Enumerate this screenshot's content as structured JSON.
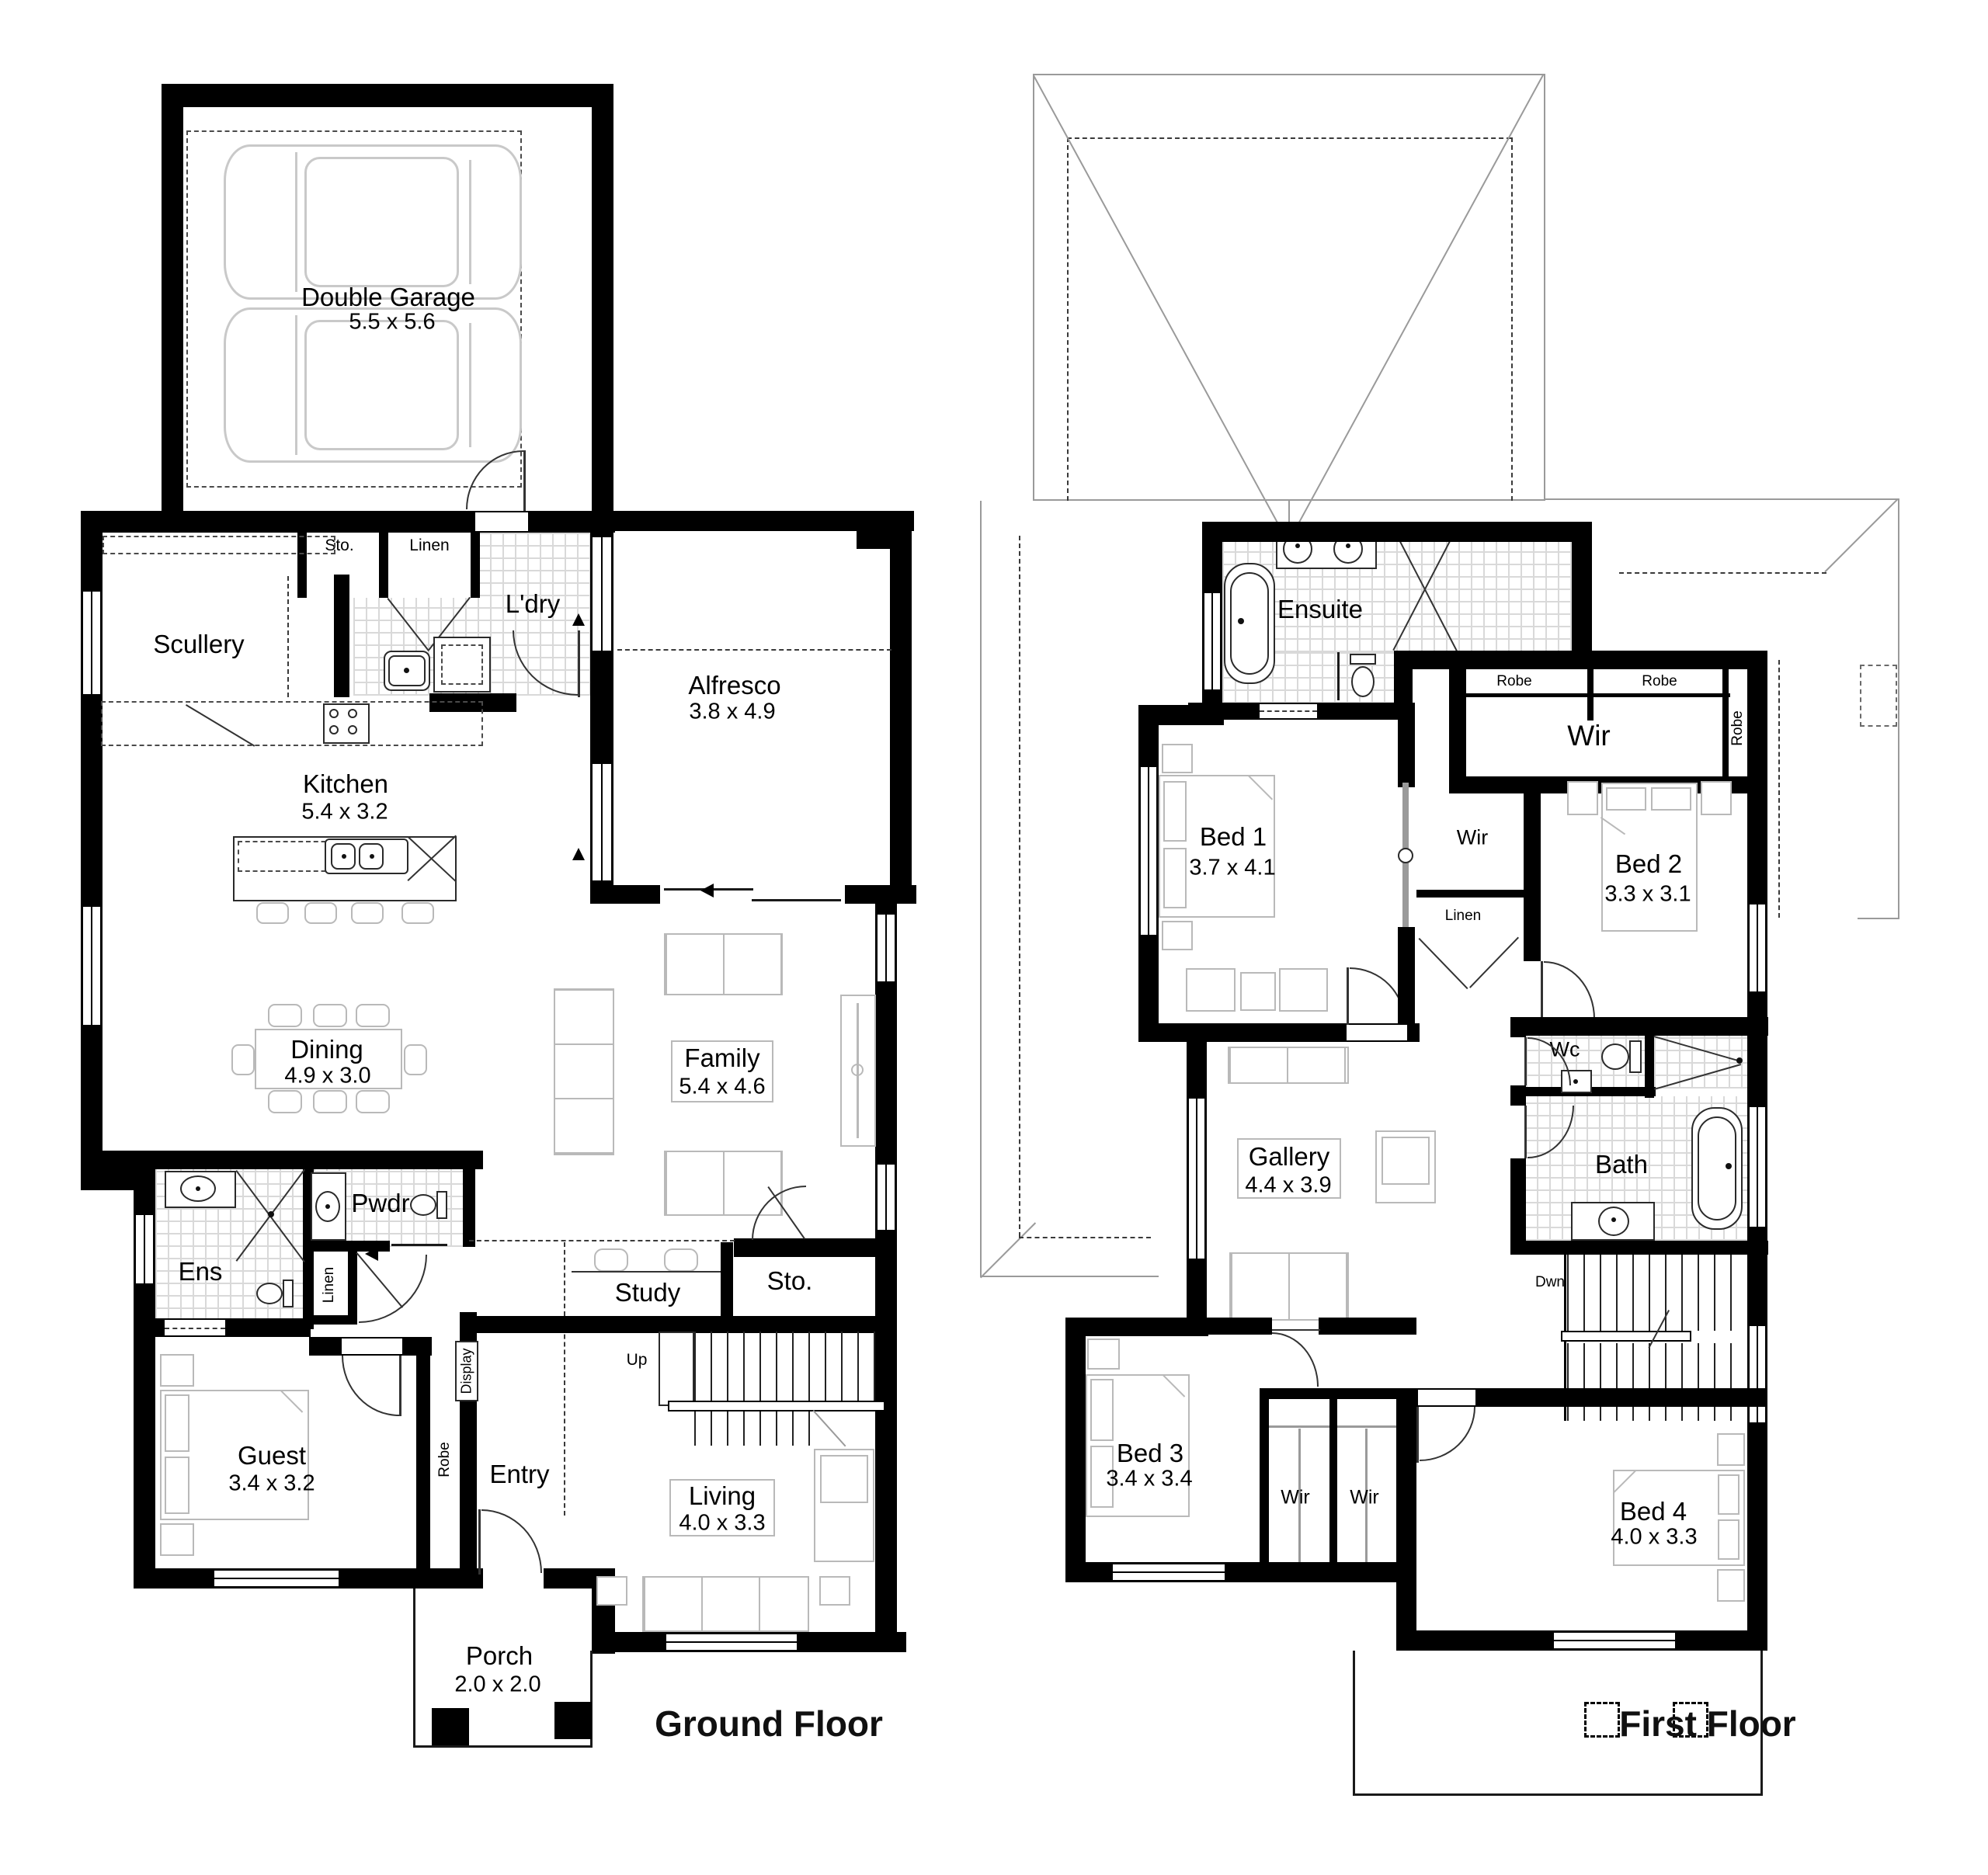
{
  "ground_floor": {
    "title": "Ground Floor",
    "garage": {
      "name": "Double Garage",
      "dims": "5.5 x 5.6"
    },
    "scullery": "Scullery",
    "sto_top": "Sto.",
    "linen_top": "Linen",
    "laundry": "L'dry",
    "alfresco": {
      "name": "Alfresco",
      "dims": "3.8 x 4.9"
    },
    "kitchen": {
      "name": "Kitchen",
      "dims": "5.4 x 3.2"
    },
    "dining": {
      "name": "Dining",
      "dims": "4.9 x 3.0"
    },
    "family": {
      "name": "Family",
      "dims": "5.4 x 4.6"
    },
    "ensuite": "Ens",
    "powder": "Pwdr",
    "linen_hall": "Linen",
    "display": "Display",
    "study": "Study",
    "storage": "Sto.",
    "stairs_up": "Up",
    "guest": {
      "name": "Guest",
      "dims": "3.4 x 3.2"
    },
    "robe": "Robe",
    "entry": "Entry",
    "living": {
      "name": "Living",
      "dims": "4.0 x 3.3"
    },
    "porch": {
      "name": "Porch",
      "dims": "2.0 x 2.0"
    }
  },
  "first_floor": {
    "title": "First Floor",
    "ensuite": "Ensuite",
    "robe_1": "Robe",
    "robe_2": "Robe",
    "robe_3": "Robe",
    "wir_main": "Wir",
    "bed1": {
      "name": "Bed 1",
      "dims": "3.7 x 4.1"
    },
    "wir_mid": "Wir",
    "linen": "Linen",
    "bed2": {
      "name": "Bed 2",
      "dims": "3.3 x 3.1"
    },
    "wc": "Wc",
    "bath": "Bath",
    "gallery": {
      "name": "Gallery",
      "dims": "4.4 x 3.9"
    },
    "stairs_down": "Dwn",
    "bed3": {
      "name": "Bed 3",
      "dims": "3.4 x 3.4"
    },
    "wir_bed3_a": "Wir",
    "wir_bed3_b": "Wir",
    "bed4": {
      "name": "Bed 4",
      "dims": "4.0 x 3.3"
    }
  }
}
